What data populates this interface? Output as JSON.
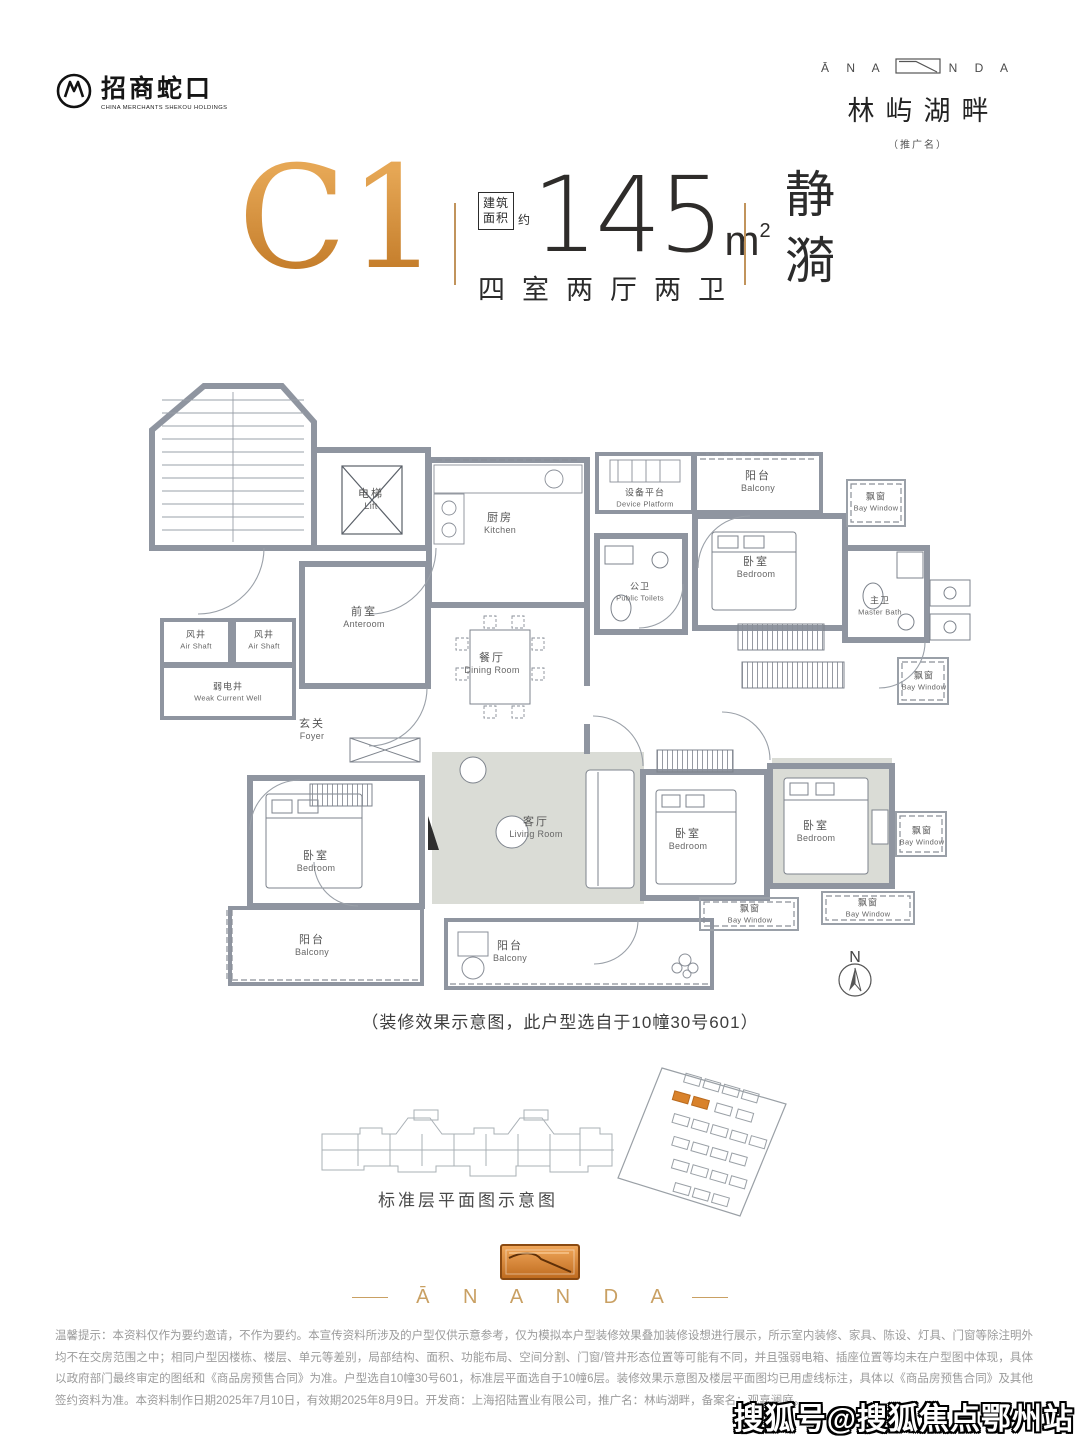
{
  "brand": {
    "developer_logo": {
      "name": "招商蛇口",
      "sub": "CHINA MERCHANTS SHEKOU HOLDINGS"
    },
    "project_logo": {
      "word_left": "Ā N A",
      "word_right": "N D A",
      "name": "林屿湖畔",
      "note": "（推广名）"
    },
    "footer_wordmark": "Ā N A N D A"
  },
  "title": {
    "unit_code": "C1",
    "area_label_line1": "建筑",
    "area_label_line2": "面积",
    "area_prefix": "约",
    "area_value": "145",
    "area_unit": "m",
    "area_exponent": "2",
    "layout_text": "四室两厅两卫",
    "tagline": "静漪"
  },
  "floorplan": {
    "caption": "（装修效果示意图，此户型选自于10幢30号601）",
    "north_label": "N",
    "rooms": {
      "lift": {
        "zh": "电梯",
        "en": "Lift"
      },
      "anteroom": {
        "zh": "前室",
        "en": "Anteroom"
      },
      "air_shaft": {
        "zh": "风井",
        "en": "Air Shaft"
      },
      "weak_current_well": {
        "zh": "弱电井",
        "en": "Weak Current Well"
      },
      "kitchen": {
        "zh": "厨房",
        "en": "Kitchen"
      },
      "dining_room": {
        "zh": "餐厅",
        "en": "Dining Room"
      },
      "device_platform": {
        "zh": "设备平台",
        "en": "Device Platform"
      },
      "public_toilets": {
        "zh": "公卫",
        "en": "Public Toilets"
      },
      "balcony": {
        "zh": "阳台",
        "en": "Balcony"
      },
      "bedroom": {
        "zh": "卧室",
        "en": "Bedroom"
      },
      "bay_window": {
        "zh": "飘窗",
        "en": "Bay Window"
      },
      "master_bath": {
        "zh": "主卫",
        "en": "Master Bath"
      },
      "foyer": {
        "zh": "玄关",
        "en": "Foyer"
      },
      "living_room": {
        "zh": "客厅",
        "en": "Living Room"
      }
    }
  },
  "bottom": {
    "standard_plan_caption": "标准层平面图示意图"
  },
  "disclaimer": "温馨提示：本资料仅作为要约邀请，不作为要约。本宣传资料所涉及的户型仅供示意参考，仅为模拟本户型装修效果叠加装修设想进行展示，所示室内装修、家具、陈设、灯具、门窗等除注明外均不在交房范围之中；相同户型因楼栋、楼层、单元等差别，局部结构、面积、功能布局、空间分割、门窗/管井形态位置等可能有不同，并且强弱电箱、插座位置等均未在户型图中体现，具体以政府部门最终审定的图纸和《商品房预售合同》为准。户型选自10幢30号601，标准层平面选自于10幢6层。装修效果示意图及楼层平面图均已用虚线标注，具体以《商品房预售合同》及其他签约资料为准。本资料制作日期2025年7月10日，有效期2025年8月9日。开发商：上海招陆置业有限公司，推广名：林屿湖畔，备案名：观嘉澜庭。",
  "watermark": "搜狐号@搜狐焦点鄂州站",
  "colors": {
    "accent_orange": "#D09044",
    "wall_gray": "#8F95A0",
    "site_highlight": "#D9822B"
  }
}
